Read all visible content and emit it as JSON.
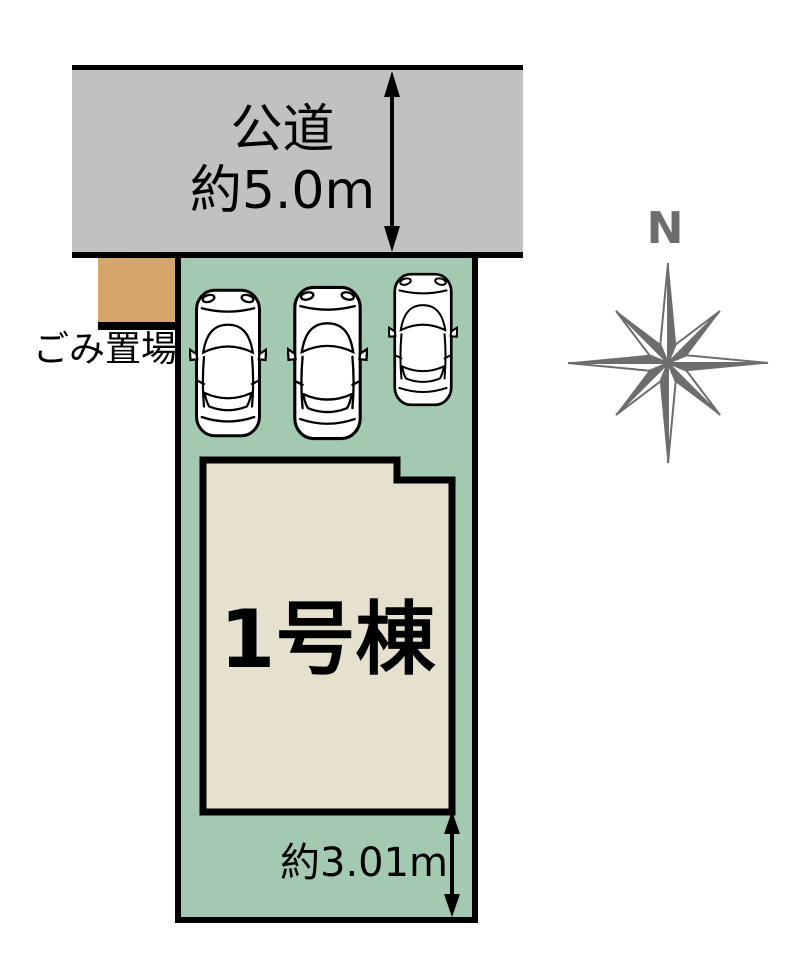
{
  "road": {
    "label": "公道",
    "width_label": "約5.0m"
  },
  "garbage": {
    "label": "ごみ置場"
  },
  "parking": {
    "car_count": 3
  },
  "building": {
    "label": "1号棟"
  },
  "plot": {
    "south_dimension_label": "約3.01m"
  },
  "compass": {
    "label": "N"
  },
  "colors": {
    "road_gray": "#C1C1C1",
    "plot_green": "#A3C9B0",
    "garbage_tan": "#D5A76C",
    "building_beige": "#E6E0CF",
    "compass_gray": "#6D6D6D",
    "line_black": "#000000"
  }
}
